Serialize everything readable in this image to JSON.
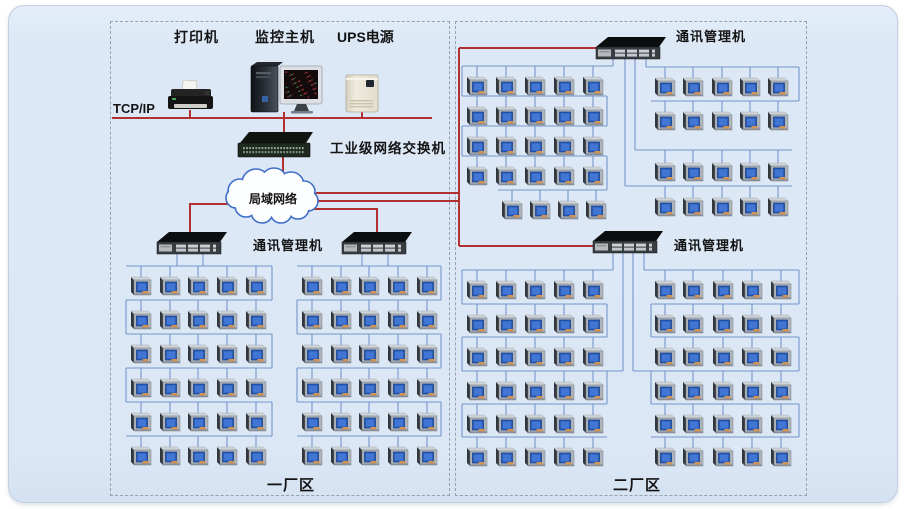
{
  "labels": {
    "printer": "打印机",
    "monitoring_host": "监控主机",
    "ups_power": "UPS电源",
    "tcpip": "TCP/IP",
    "industrial_switch": "工业级网络交换机",
    "lan_cloud": "局域网络",
    "comm_manager": "通讯管理机",
    "factory_area_1": "一厂区",
    "factory_area_2": "二厂区"
  },
  "colors": {
    "panel_bg": "#dce8f5",
    "red_wire": "#b23030",
    "blue_wire": "#7396cc",
    "dashed_border": "#97a0ab",
    "meter_screen": "#2b5cb8",
    "meter_screen_inner": "#4276d4"
  },
  "inventory": {
    "comm_manager_switches": 4,
    "meters_factory_area_1": 60,
    "meters_factory_area_2": 104
  }
}
